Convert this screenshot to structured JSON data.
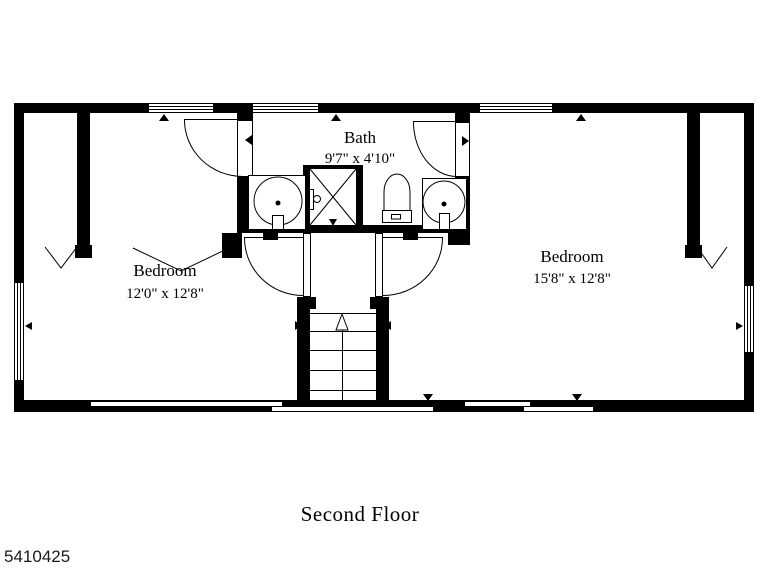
{
  "title": "Second Floor",
  "listing_id": "5410425",
  "rooms": {
    "bath": {
      "name": "Bath",
      "dims": "9'7\" x 4'10\""
    },
    "bedroom_left": {
      "name": "Bedroom",
      "dims": "12'0\" x 12'8\""
    },
    "bedroom_right": {
      "name": "Bedroom",
      "dims": "15'8\" x 12'8\""
    }
  },
  "colors": {
    "wall": "#000000",
    "background": "#ffffff",
    "line": "#000000"
  }
}
